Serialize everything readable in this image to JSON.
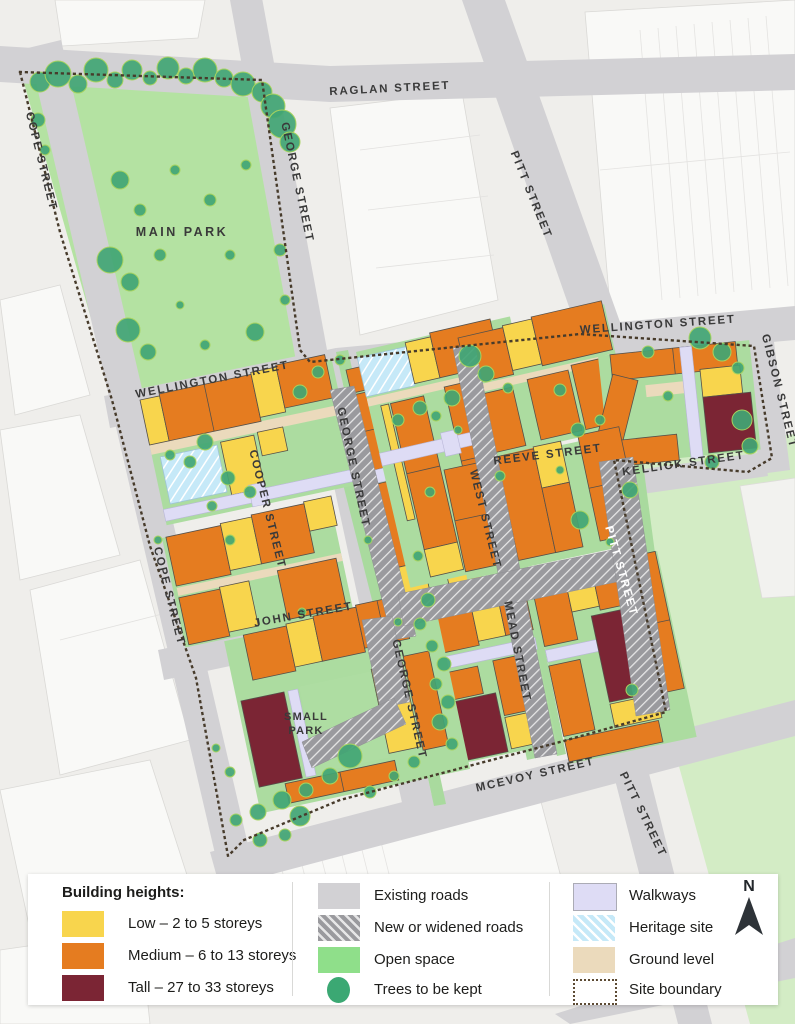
{
  "map": {
    "streets": {
      "raglan": "RAGLAN STREET",
      "cope_upper": "COPE STREET",
      "cope_lower": "COPE STREET",
      "george_upper": "GEORGE STREET",
      "george_middle": "GEORGE STREET",
      "george_lower": "GEORGE STREET",
      "pitt_upper": "PITT STREET",
      "pitt_middle": "PITT STREET",
      "pitt_lower": "PITT STREET",
      "wellington_west": "WELLINGTON STREET",
      "wellington_east": "WELLINGTON STREET",
      "cooper": "COOPER STREET",
      "west": "WEST STREET",
      "reeve": "REEVE STREET",
      "kellick": "KELLICK STREET",
      "gibson": "GIBSON STREET",
      "john": "JOHN STREET",
      "mead": "MEAD STREET",
      "mcevoy": "MCEVOY STREET"
    },
    "parks": {
      "main": "MAIN PARK",
      "small_line1": "SMALL",
      "small_line2": "PARK"
    }
  },
  "legend": {
    "title": "Building heights:",
    "building_heights": [
      {
        "label": "Low – 2 to 5 storeys",
        "color": "#F8D54D"
      },
      {
        "label": "Medium – 6 to 13 storeys",
        "color": "#E57C20"
      },
      {
        "label": "Tall – 27 to 33 storeys",
        "color": "#7B2534"
      }
    ],
    "map_features": [
      {
        "label": "Existing roads",
        "color": "#D2D1D4"
      },
      {
        "label": "New or widened roads",
        "color": "#9A9A9E",
        "pattern": "diagonal-hatch"
      },
      {
        "label": "Open space",
        "color": "#8FDF8A"
      },
      {
        "label": "Trees to be kept",
        "color": "#3BA873",
        "shape": "circle"
      }
    ],
    "site_features": [
      {
        "label": "Walkways",
        "color": "#DEDCF5"
      },
      {
        "label": "Heritage site",
        "color": "#C6E9F8",
        "pattern": "diagonal-hatch"
      },
      {
        "label": "Ground level",
        "color": "#EBDABC"
      },
      {
        "label": "Site boundary",
        "style": "dotted-outline",
        "color": "#5C4A33"
      }
    ]
  },
  "compass": {
    "north_label": "N"
  },
  "colors": {
    "background": "#EFEEEB",
    "existing_road": "#D2D1D4",
    "main_park_green": "#B4E2A2",
    "open_space_green": "#D3ECC5",
    "block_courtyard_green": "#ACDCA0",
    "building_low": "#F8D54D",
    "building_medium": "#E57C20",
    "building_tall": "#7B2534",
    "walkway": "#DEDCF5",
    "heritage": "#C6E9F8",
    "ground_level": "#EBDABC",
    "tree": "#3BA873",
    "boundary_dots": "#473B2B"
  }
}
